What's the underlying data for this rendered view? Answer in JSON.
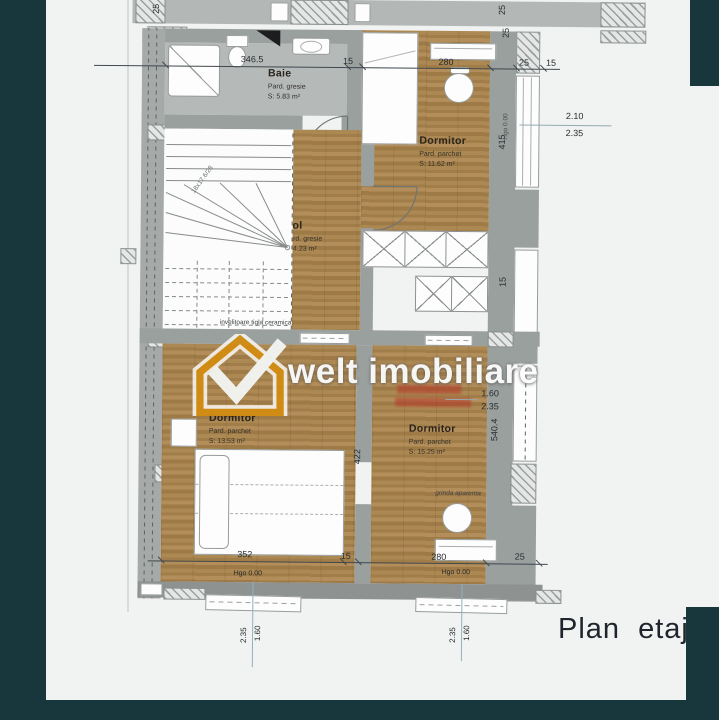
{
  "meta": {
    "title": "Plan etaj"
  },
  "colors": {
    "frame_teal": "#17373d",
    "paper": "#f1f3f2",
    "wood_floor": "#a6834f",
    "tile_floor": "#b5bab9",
    "wall_gray": "#9aa09e",
    "watermark_orange": "#d28c12",
    "stamp_red": "#b63728",
    "mark_line_blue": "#8fb3ba"
  },
  "title_block": {
    "label": "Plan etaj"
  },
  "watermark": {
    "text": "welt imobiliare"
  },
  "rooms": {
    "baie": {
      "name": "Baie",
      "floor": "Pard. gresie",
      "area": "S:  5.83 m²"
    },
    "dormitor_ne": {
      "name": "Dormitor",
      "floor": "Pard. parchet",
      "area": "S:  11.62 m²"
    },
    "hol": {
      "name": "Hol",
      "floor": "Pard. gresie",
      "area": "S:  4.23 m²"
    },
    "dormitor_sw": {
      "name": "Dormitor",
      "floor": "Pard. parchet",
      "area": "S:  13.53 m²"
    },
    "dormitor_se": {
      "name": "Dormitor",
      "floor": "Pard. parchet",
      "area": "S:  15.25 m²"
    }
  },
  "dims": {
    "top": {
      "a": "346.5",
      "b": "15",
      "c": "280",
      "d": "25",
      "e": "15"
    },
    "bottom": {
      "a": "352",
      "b": "15",
      "c": "280",
      "d": "25"
    },
    "v415": "415",
    "v422": "422",
    "v5404": "540.4",
    "v15": "15",
    "wall25_tl": "25",
    "wall25_tr1": "25",
    "wall25_tr2": "25"
  },
  "levels": {
    "hgo": "Hgo 0.00"
  },
  "heights": {
    "right": {
      "top": "2.10",
      "bot": "2.35"
    },
    "mid": {
      "top": "1.60",
      "bot": "2.35"
    },
    "b1": {
      "l": "2.35",
      "r": "1.60"
    },
    "b2": {
      "l": "2.35",
      "r": "1.60"
    }
  },
  "annotations": {
    "roof": "invelitoare tigla ceramica",
    "beam": "grinda aparenta",
    "stairs": "18x17.6/28"
  }
}
